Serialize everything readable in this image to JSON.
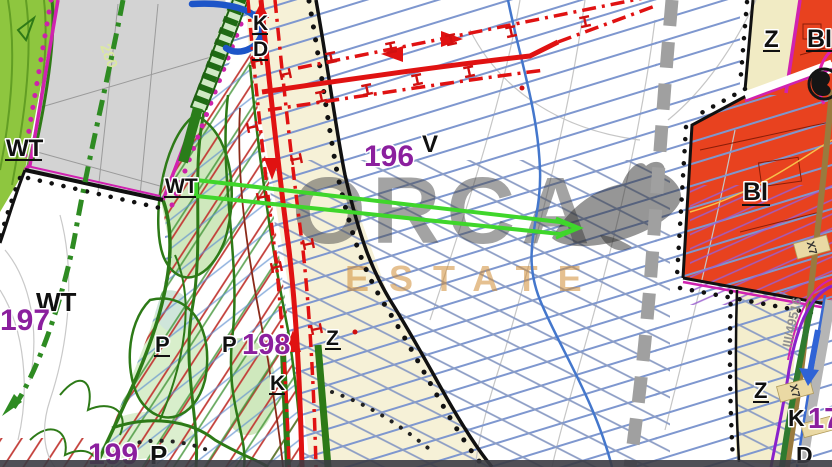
{
  "map": {
    "watermark": {
      "title": "ORCA",
      "subtitle": "ESTATE"
    },
    "labels": {
      "wt_upper": "WT",
      "wt_mid": "WT",
      "wt_lower": "WT",
      "parcel_197": "197",
      "parcel_196": "196",
      "parcel_198": "198",
      "parcel_199": "199",
      "parcel_17": "17",
      "zone_v": "V",
      "k_top": "K",
      "d_top": "D",
      "z_top_right": "Z",
      "bi_top_right": "BI",
      "bi_right": "BI",
      "z_center": "Z",
      "z_bottom_right": "Z",
      "p_left": "P",
      "p_center": "P",
      "p_bottom": "P",
      "k_center": "K",
      "k_bottom_right": "K",
      "d_bottom_right": "D",
      "elevation_280": "280",
      "road_ref": "III/49516",
      "x7_upper": "X7",
      "x7_lower": "X7"
    },
    "colors": {
      "zone_red": "#e8421f",
      "zone_gray": "#d3d3d3",
      "zone_green": "#8ec63f",
      "zone_beige": "#f6f1d7",
      "zone_cream": "#f1ebc4",
      "hatch_blue": "#7e97cf",
      "hatch_red": "#c23b36",
      "hatch_purple": "#9a5fd0",
      "road_red": "#e01212",
      "boundary_magenta": "#d022b0",
      "boundary_black": "#111111",
      "corridor_green": "#3fd62b",
      "dashdot_green": "#2e8b22",
      "road_gray_dashed": "#a0a0a0",
      "road_brown": "#9a7a3e"
    }
  }
}
